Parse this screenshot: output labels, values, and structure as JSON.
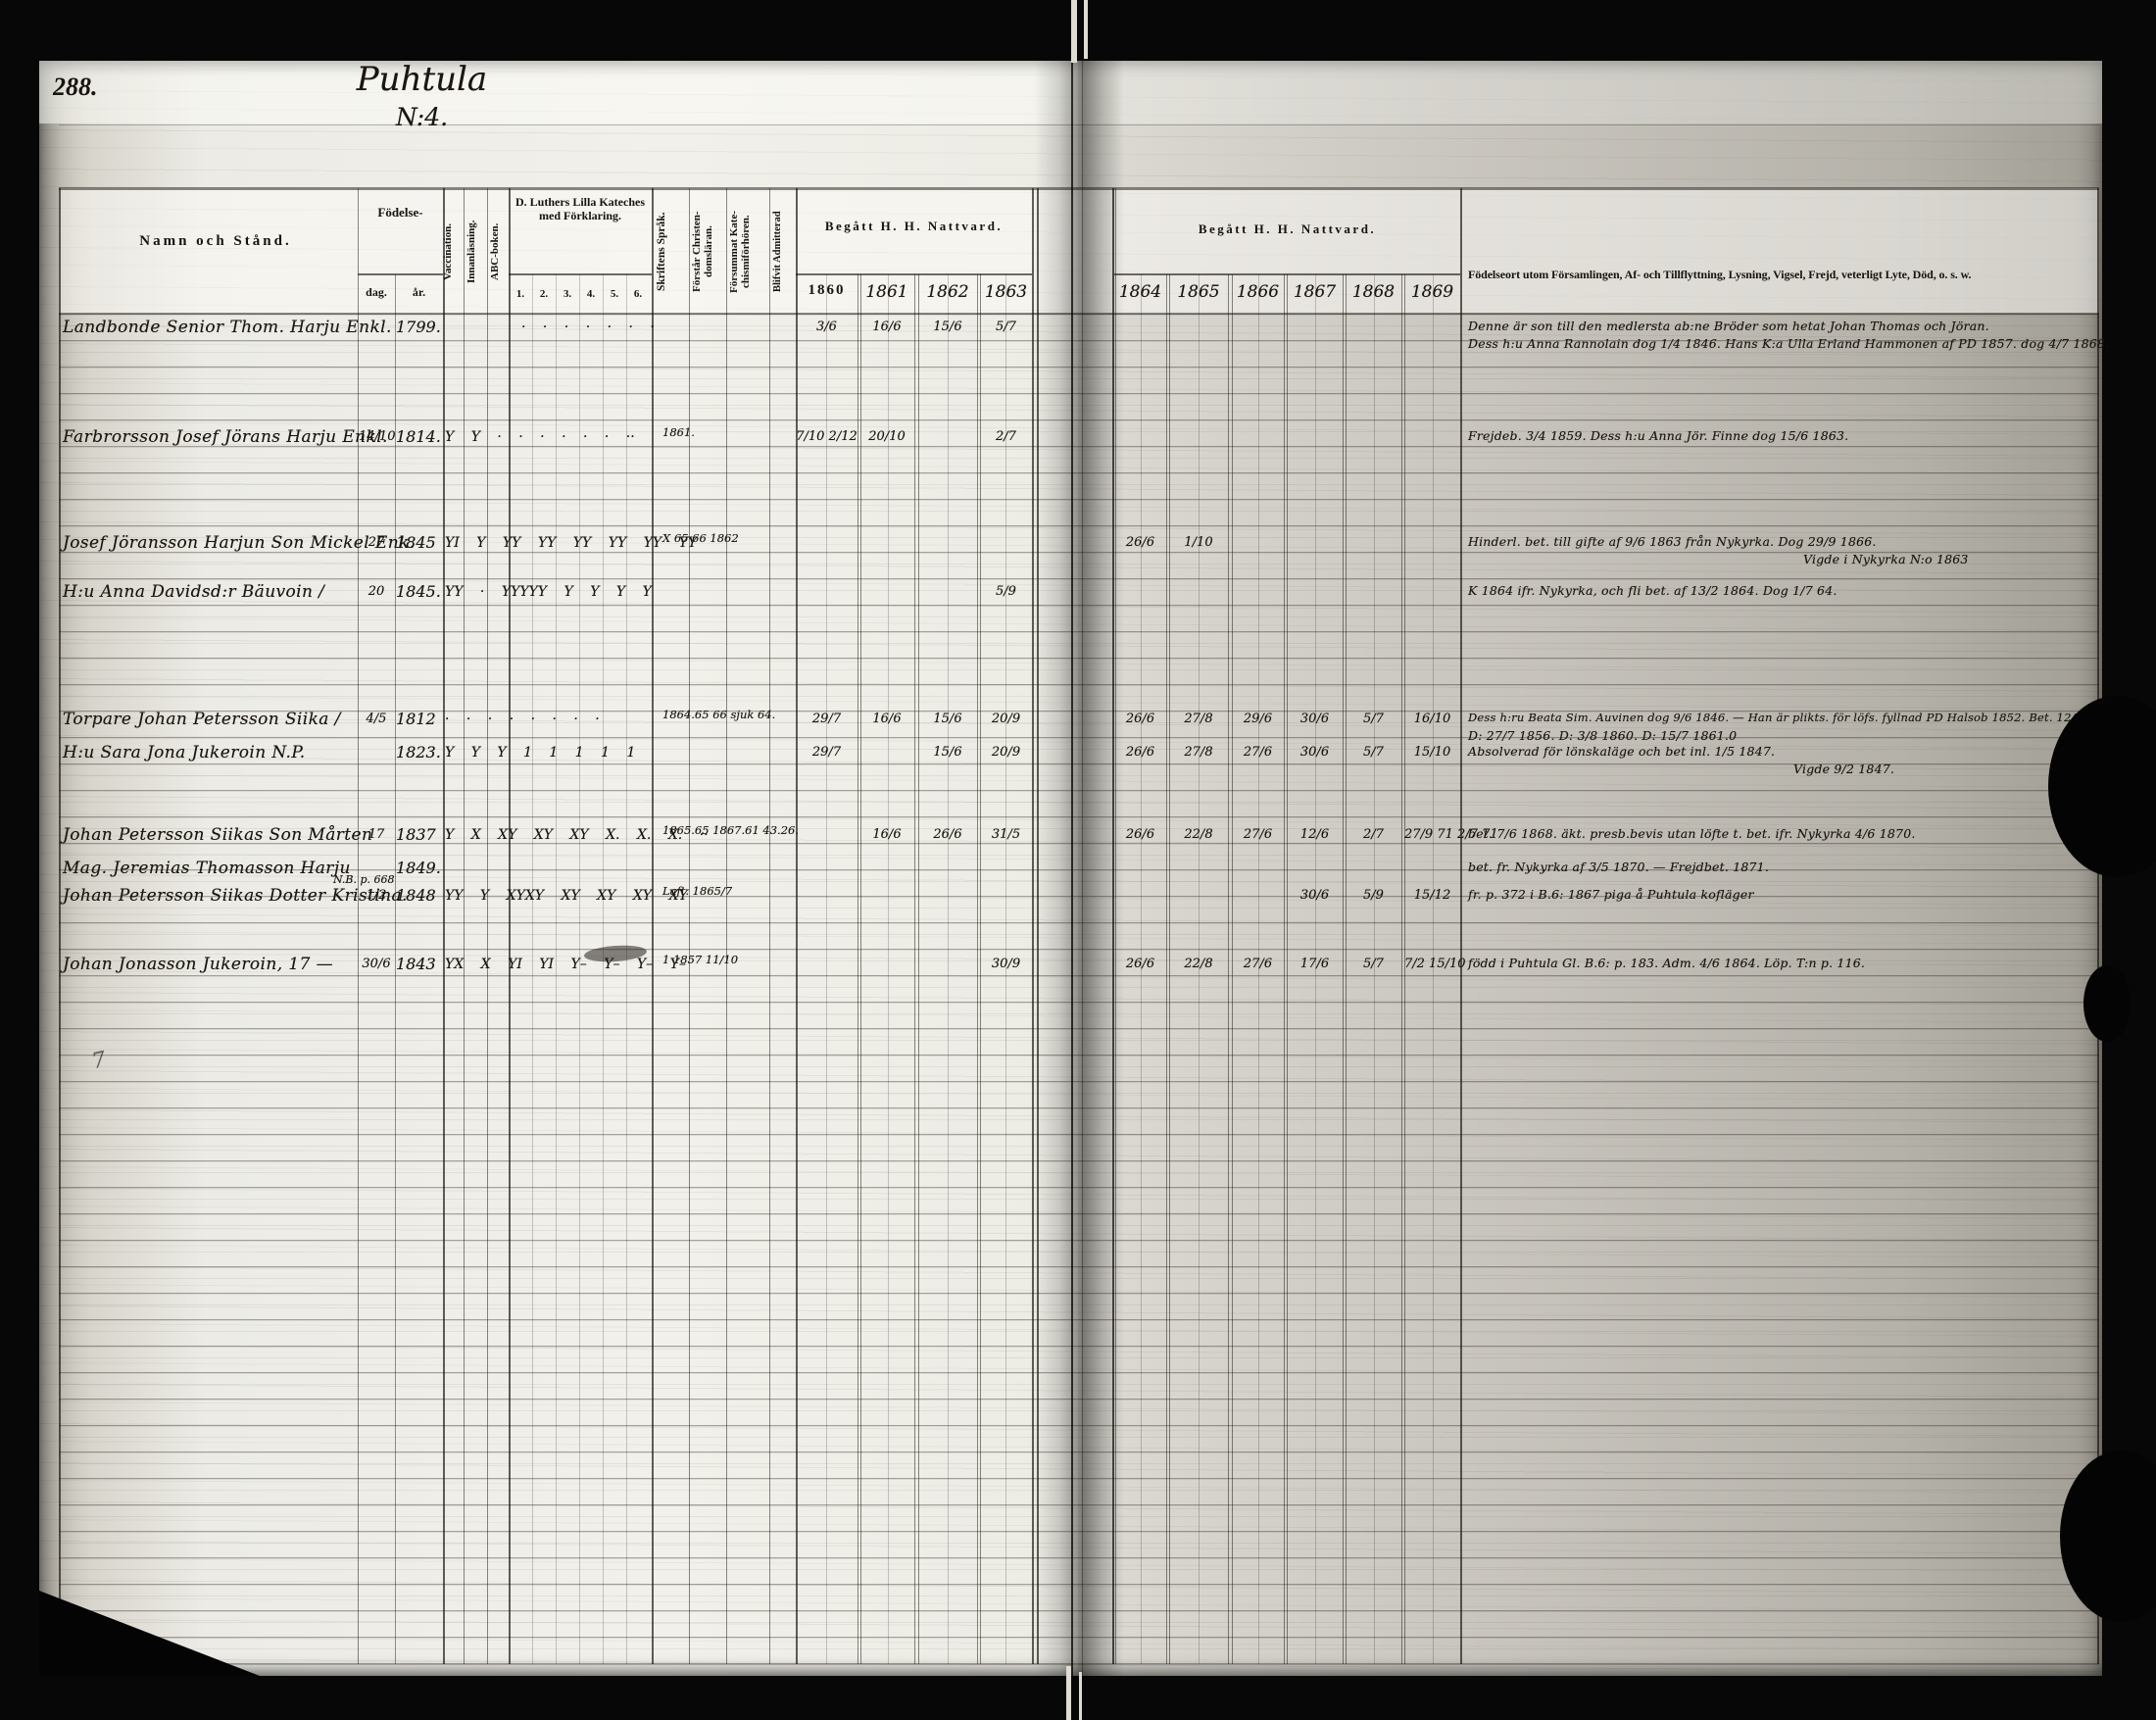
{
  "page": {
    "number": "288.",
    "title": "Puhtula",
    "subtitle": "N:4.",
    "flourish": "7"
  },
  "header": {
    "name_col": "Namn och Stånd.",
    "birth": "Födelse-",
    "birth_day": "dag.",
    "birth_year": "år.",
    "vaccination": "Vaccination.",
    "reading": "Innanläsning.",
    "abc_book": "ABC-boken.",
    "catechism": "D. Luthers Lilla Kateches med Förklaring.",
    "catechism_cols": [
      "1.",
      "2.",
      "3.",
      "4.",
      "5.",
      "6."
    ],
    "scripture": "Skriftens Språk.",
    "understands": "Förstår Christen-domsläran.",
    "missed": "Försummat Kate-chismiförhören.",
    "admitted": "Blifvit Admitterad",
    "communion_left": "Begått H. H. Nattvard.",
    "communion_right": "Begått H. H. Nattvard.",
    "years_left": [
      "1860",
      "1861",
      "1862",
      "1863"
    ],
    "years_right": [
      "1864",
      "1865",
      "1866",
      "1867",
      "1868",
      "1869"
    ],
    "remarks": "Födelseort utom Församlingen, Af- och Tillflyttning, Lysning, Vigsel, Frejd, veterligt Lyte, Död, o. s. w."
  },
  "rows": [
    {
      "name": "Landbonde Senior Thom. Harju Enkl.",
      "day": "",
      "year": "1799.",
      "marks": "· · · · · · ·",
      "note": "",
      "c1860": "3/6",
      "c1861": "16/6",
      "c1862": "15/6",
      "c1863": "5/7",
      "c1864": "",
      "c1865": "",
      "c1866": "",
      "c1867": "",
      "c1868": "",
      "c1869": "",
      "rem1": "Denne är son till den medlersta ab:ne Bröder som hetat Johan Thomas och Jöran.",
      "rem2": "Dess h:u Anna Rannolain dog 1/4 1846. Hans K:a Ulla Erland Hammonen af PD 1857. dog 4/7 1868."
    },
    {
      "name": "Farbrorsson Josef Jörans Harju Enkl.",
      "day": "14/10",
      "year": "1814.",
      "marks": "Y Y · · · · · ·  ··",
      "note": "1861.",
      "c1860": "7/10 2/12",
      "c1861": "20/10",
      "c1862": "",
      "c1863": "2/7",
      "c1864": "",
      "c1865": "",
      "c1866": "",
      "c1867": "",
      "c1868": "",
      "c1869": "",
      "rem1": "Frejdeb. 3/4 1859. Dess h:u Anna Jör. Finne dog 15/6 1863.",
      "rem2": ""
    },
    {
      "name": "Josef Jöransson Harjun Son Mickel Enk.",
      "day": "27",
      "year": "1845",
      "marks": "YI Y YY YY YY YY YY YY",
      "note": "X  65·66  1862",
      "c1860": "",
      "c1861": "",
      "c1862": "",
      "c1863": "",
      "c1864": "26/6",
      "c1865": "1/10",
      "c1866": "",
      "c1867": "",
      "c1868": "",
      "c1869": "",
      "rem1": "Hinderl. bet. till gifte af 9/6 1863 från Nykyrka.    Dog 29/9 1866.",
      "rem2": "Vigde i Nykyrka N:o 1863"
    },
    {
      "name": "H:u Anna Davidsd:r Bäuvoin /",
      "day": "20",
      "year": "1845.",
      "marks": "YY · YYYYY Y Y Y   Y",
      "note": "",
      "c1860": "",
      "c1861": "",
      "c1862": "",
      "c1863": "5/9",
      "c1864": "",
      "c1865": "",
      "c1866": "",
      "c1867": "",
      "c1868": "",
      "c1869": "",
      "rem1": "K 1864 ifr. Nykyrka, och fli bet. af 13/2 1864.  Dog 1/7 64.",
      "rem2": ""
    },
    {
      "name": "Torpare Johan Petersson Siika /",
      "day": "4/5",
      "year": "1812",
      "marks": "· · · · · · · ·",
      "note": "1864.65 66 sjuk 64.",
      "c1860": "29/7",
      "c1861": "16/6",
      "c1862": "15/6",
      "c1863": "20/9",
      "c1864": "26/6",
      "c1865": "27/8",
      "c1866": "29/6",
      "c1867": "30/6",
      "c1868": "5/7",
      "c1869": "16/10",
      "rem1": "Dess h:ru Beata Sim. Auvinen dog 9/6 1846. — Han är plikts. för löfs. fyllnad PD Halsob 1852. Bet. 12/10 1877.",
      "rem2": "D: 27/7 1856. D: 3/8 1860. D: 15/7 1861.0"
    },
    {
      "name": "H:u Sara Jona Jukeroin   N.P.",
      "day": "",
      "year": "1823.",
      "marks": "Y Y Y 1 1 1 1 1",
      "note": "",
      "c1860": "29/7",
      "c1861": "",
      "c1862": "15/6",
      "c1863": "20/9",
      "c1864": "26/6",
      "c1865": "27/8",
      "c1866": "27/6",
      "c1867": "30/6",
      "c1868": "5/7",
      "c1869": "15/10",
      "rem1": "Absolverad för lönskaläge och bet inl. 1/5 1847.",
      "rem2": "Vigde 9/2 1847."
    },
    {
      "name": "Johan Petersson Siikas Son Mårten",
      "day": "17",
      "year": "1837",
      "marks": "Y X XY XY XY X. X. X.  ··",
      "note": "1865.65 1867.61 43.26.",
      "c1860": "",
      "c1861": "16/6",
      "c1862": "26/6",
      "c1863": "31/5",
      "c1864": "26/6",
      "c1865": "22/8",
      "c1866": "27/6",
      "c1867": "12/6",
      "c1868": "2/7",
      "c1869": "27/9 71 2/7 71",
      "rem1": "bet. 7/6 1868. äkt. presb.bevis utan löfte t. bet. ifr. Nykyrka 4/6 1870.",
      "rem2": ""
    },
    {
      "name": "Mag. Jeremias Thomasson Harju",
      "day": "",
      "year": "1849.",
      "marks": "",
      "note": "N.B. p. 668",
      "c1860": "",
      "c1861": "",
      "c1862": "",
      "c1863": "",
      "c1864": "",
      "c1865": "",
      "c1866": "",
      "c1867": "",
      "c1868": "",
      "c1869": "",
      "rem1": "bet. fr. Nykyrka af 3/5 1870. — Frejdbet. 1871.",
      "rem2": ""
    },
    {
      "name": "Johan Petersson Siikas Dotter Kristina.",
      "day": "1/2",
      "year": "1848",
      "marks": "YY Y XYXY XY XY XY XY",
      "note": "Laft. 1865/7",
      "c1860": "",
      "c1861": "",
      "c1862": "",
      "c1863": "",
      "c1864": "",
      "c1865": "",
      "c1866": "",
      "c1867": "30/6",
      "c1868": "5/9",
      "c1869": "15/12",
      "rem1": "fr. p. 372 i B.6: 1867 piga å Puhtula kofläger",
      "rem2": ""
    },
    {
      "name": "Johan Jonasson Jukeroin, 17 —",
      "day": "30/6",
      "year": "1843",
      "marks": "YX X YI YI Y– Y– Y– Y–",
      "note": "1  1857 11/10",
      "c1860": "",
      "c1861": "",
      "c1862": "",
      "c1863": "30/9",
      "c1864": "26/6",
      "c1865": "22/8",
      "c1866": "27/6",
      "c1867": "17/6",
      "c1868": "5/7",
      "c1869": "7/2 15/10",
      "rem1": "född i Puhtula Gl. B.6: p. 183. Adm. 4/6 1864. Löp. T:n p. 116.",
      "rem2": ""
    }
  ]
}
